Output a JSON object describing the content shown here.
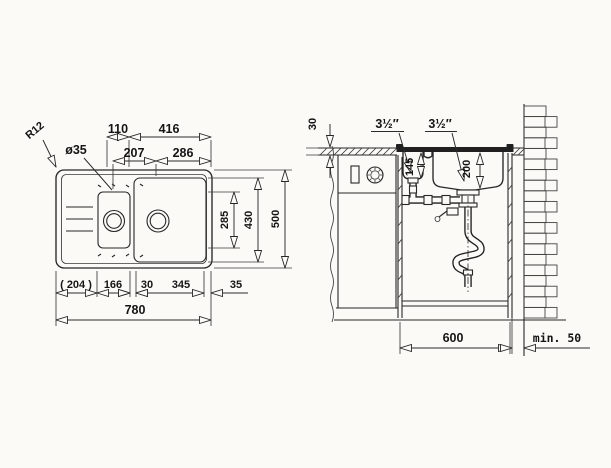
{
  "view_top": {
    "radius": "R12",
    "hole_diameter": "ø35",
    "dim_110": "110",
    "dim_416": "416",
    "dim_207": "207",
    "dim_286": "286",
    "dim_285": "285",
    "dim_430": "430",
    "dim_500": "500",
    "dim_204": "( 204 )",
    "dim_166": "166",
    "dim_30": "30",
    "dim_345": "345",
    "dim_35": "35",
    "dim_780": "780"
  },
  "view_section": {
    "counter_thickness": "30",
    "drain_size_1": "3½″",
    "drain_size_2": "3½″",
    "depth_small_bowl": "145",
    "depth_large_bowl": "200",
    "cabinet_depth": "600",
    "wall_gap": "min. 50"
  }
}
